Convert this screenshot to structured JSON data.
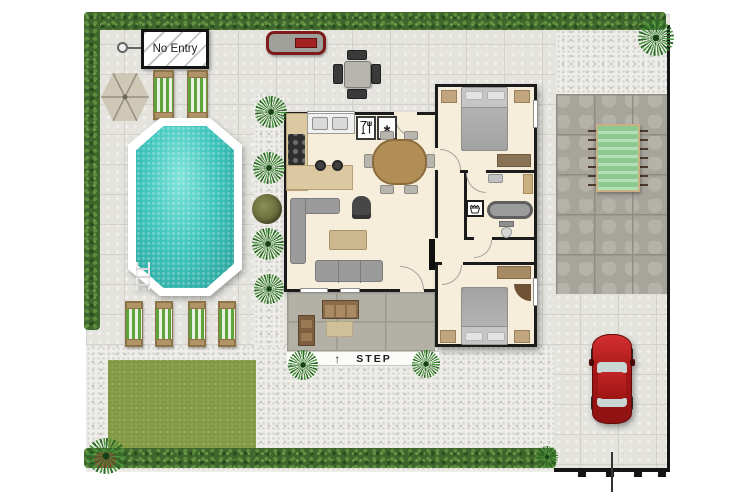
{
  "scene": {
    "description": "Top-down site plan of a holiday home with garden, swimming pool, porch, stone patio and parking",
    "signs": {
      "no_entry": "No Entry",
      "step_label": "STEP",
      "step_arrow": "↑"
    },
    "symbols": {
      "freezer_glyph": "*",
      "dishwasher_icon": "wine-glass-and-fork",
      "laundry_icon": "wash-tub"
    },
    "colors": {
      "pavement": "#e4e3de",
      "gravel": "#eeede9",
      "dark_patio": "#a6a49b",
      "porch_stone": "#b3b0a6",
      "lawn": "#8a9f4b",
      "hedge": "#3f662c",
      "pool_water": "#3fc8bf",
      "pool_rim": "#ffffff",
      "house_floor": "#f6eedb",
      "wall": "#1b1b1b",
      "car_body": "#b02020",
      "bbq_accent": "#8f1d1d",
      "pergola_green": "#9ed2a0",
      "lounger_green": "#5fa33c",
      "wood": "#b09468"
    },
    "objects": [
      "hedge border",
      "no-entry sign with gate symbol",
      "parasol",
      "2 sun loungers beside pool",
      "barbecue grill",
      "outdoor dining table with 4 chairs",
      "octagonal swimming pool with ladder",
      "4 sun loungers in a row",
      "lawn",
      "house with kitchen, living-dining room, 2 bedrooms, bathroom and hall",
      "covered porch with bench, shelf and doormat",
      "step marker with arrow",
      "dark stone patio with slatted pergola table",
      "red car parked on driveway",
      "potted and bedded plants"
    ]
  }
}
